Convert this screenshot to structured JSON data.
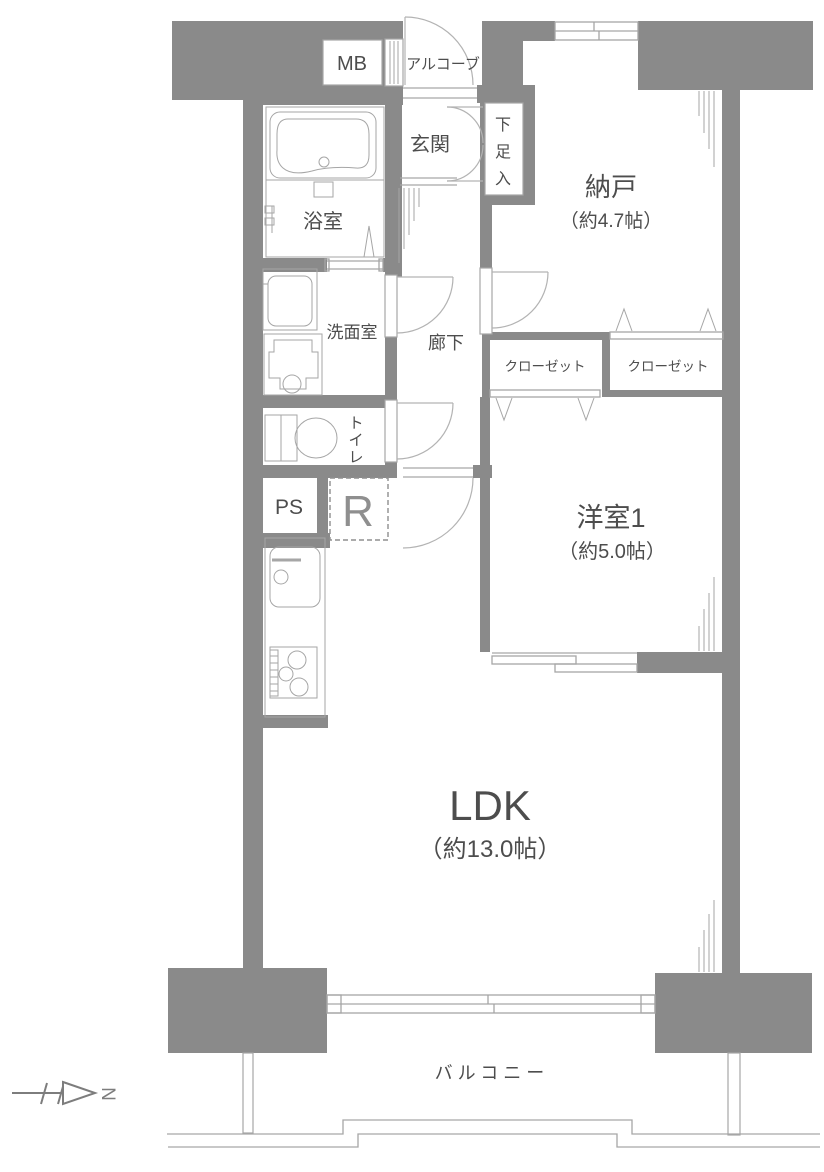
{
  "rooms": {
    "entrance": "玄関",
    "alcove": "アルコーブ",
    "meter_box": "MB",
    "shoe_cabinet": "下足入",
    "storage": {
      "name": "納戸",
      "area": "（約4.7帖）"
    },
    "bathroom": "浴室",
    "washroom": "洗面室",
    "corridor": "廊下",
    "toilet": "トイレ",
    "pipe_shaft": "PS",
    "refrigerator_space": "R",
    "closet_left": "クローゼット",
    "closet_right": "クローゼット",
    "western_room": {
      "name": "洋室1",
      "area": "（約5.0帖）"
    },
    "ldk": {
      "name": "LDK",
      "area": "（約13.0帖）"
    },
    "balcony": "バルコニー"
  },
  "compass": {
    "north": "N"
  },
  "colors": {
    "wall": "#8a8a8a",
    "line": "#a6a6a6",
    "door": "#b3b3b3",
    "text": "#4d4d4d",
    "muted": "#8f8f8f"
  }
}
